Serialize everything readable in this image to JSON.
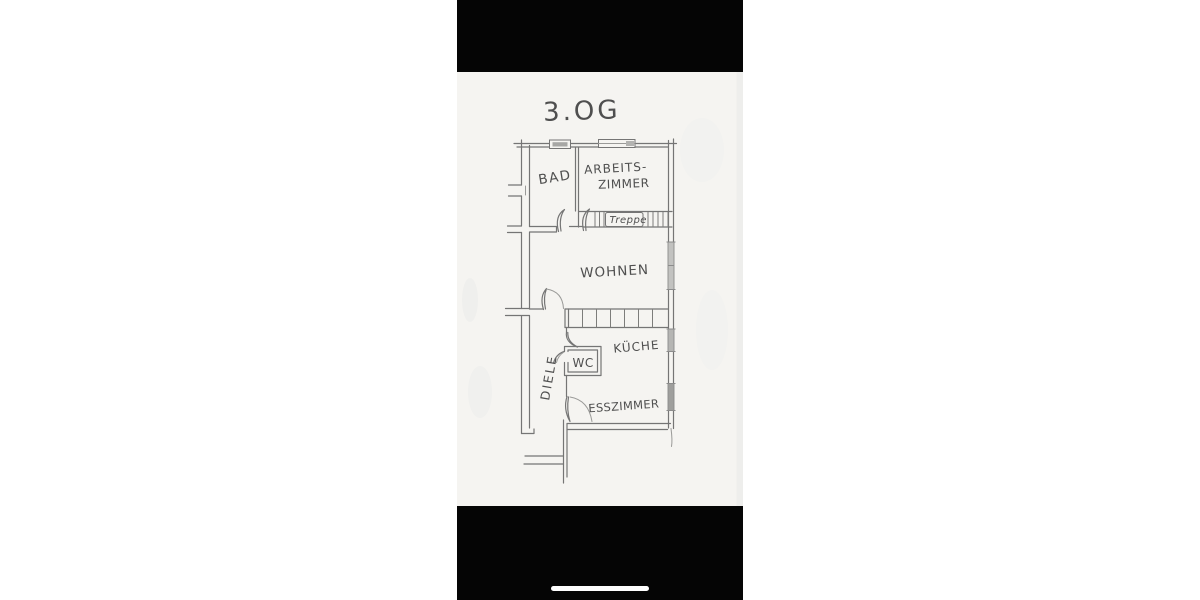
{
  "frame": {
    "background_color": "#ffffff",
    "top_bar_color": "#050505",
    "bottom_bar_color": "#050505",
    "paper_color": "#f5f4f1",
    "home_indicator_color": "#fefefe",
    "pencil_color": "#757575",
    "label_color": "#4f4f4f"
  },
  "plan": {
    "title": "3.OG",
    "labels": {
      "bad": "BAD",
      "arbeitszimmer_line1": "ARBEITS-",
      "arbeitszimmer_line2": "ZIMMER",
      "treppe": "Treppe",
      "wohnen": "WOHNEN",
      "kueche": "KÜCHE",
      "wc": "WC",
      "diele": "DIELE",
      "esszimmer": "ESSZIMMER"
    }
  }
}
